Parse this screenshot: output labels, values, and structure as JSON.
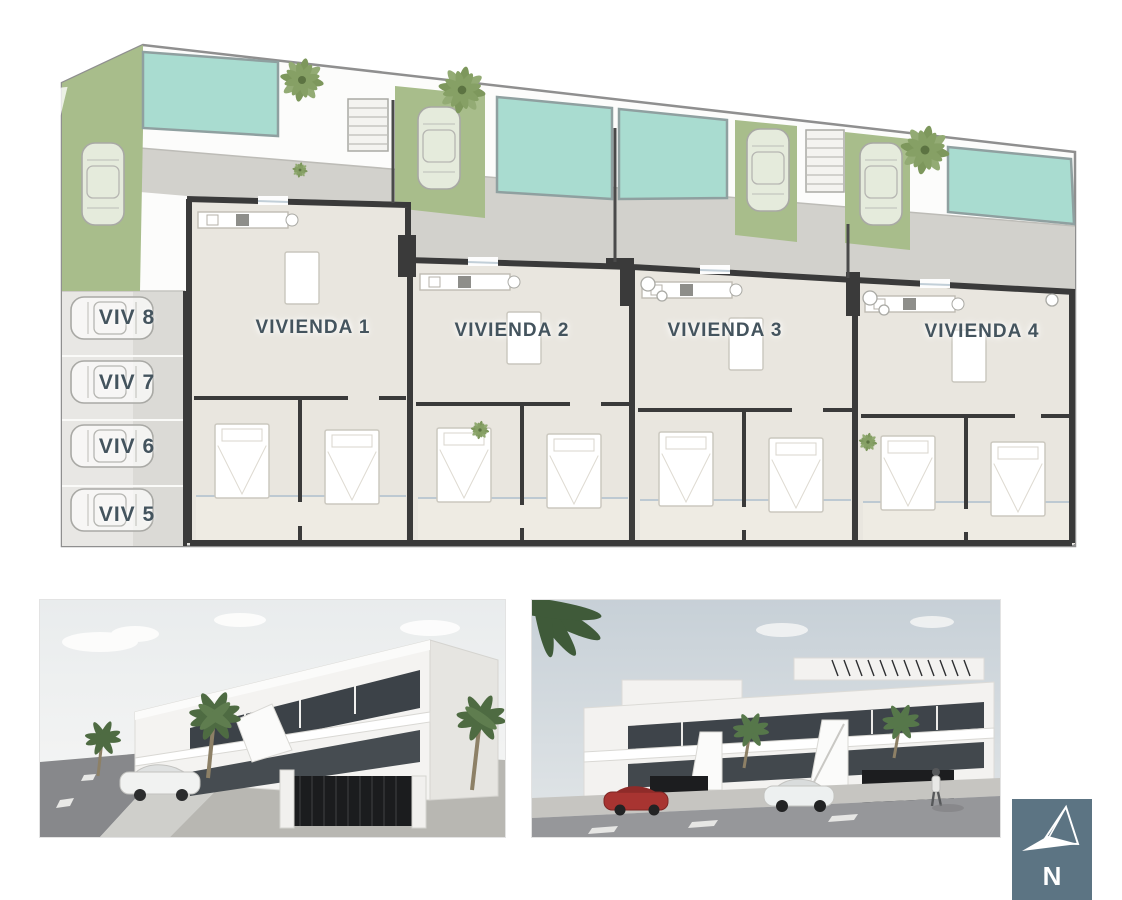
{
  "canvas": {
    "width": 1122,
    "height": 900,
    "background": "#ffffff"
  },
  "watermark": {
    "line1": "blanco",
    "line2": "reality"
  },
  "floor_plan": {
    "units": [
      {
        "label": "VIVIENDA 1"
      },
      {
        "label": "VIVIENDA 2"
      },
      {
        "label": "VIVIENDA 3"
      },
      {
        "label": "VIVIENDA 4"
      }
    ],
    "parking_spaces": [
      {
        "label": "VIV 8"
      },
      {
        "label": "VIV 7"
      },
      {
        "label": "VIV 6"
      },
      {
        "label": "VIV 5"
      }
    ],
    "colors": {
      "pool": "#a9dcd0",
      "grass": "#a8bd8b",
      "floor": "#e9e6df",
      "driveway": "#d2d1cc",
      "wall": "#3a3a3a",
      "label_text": "#44545e"
    }
  },
  "renders": {
    "left": "building-exterior-corner-render",
    "right": "building-exterior-street-render"
  },
  "compass": {
    "label": "N",
    "background": "#5c7483"
  }
}
